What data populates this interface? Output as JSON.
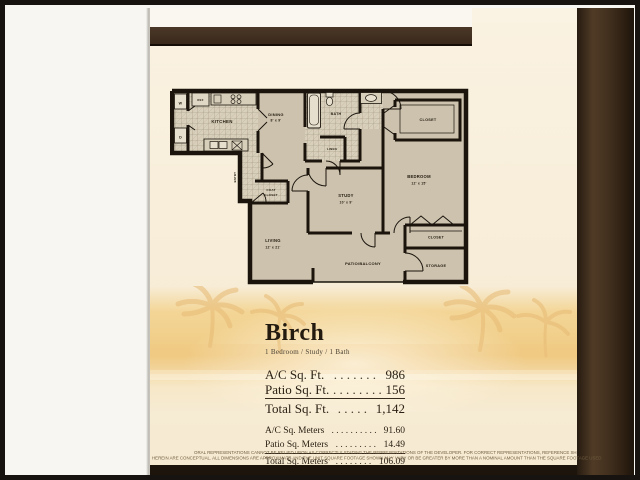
{
  "page": {
    "title": "Birch",
    "subtitle": "1 Bedroom / Study / 1 Bath",
    "stats_ft": [
      {
        "label": "A/C Sq. Ft.",
        "dots": ". . . . . . .",
        "value": "986"
      },
      {
        "label": "Patio Sq. Ft.",
        "dots": ". . . . . . . .",
        "value": "156"
      },
      {
        "label": "Total Sq. Ft.",
        "dots": ". . . . .",
        "value": "1,142"
      }
    ],
    "stats_meters": [
      {
        "label": "A/C Sq. Meters",
        "dots": ". . . . . . . . . .",
        "value": "91.60"
      },
      {
        "label": "Patio Sq. Meters",
        "dots": ". . . . . . . . .",
        "value": "14.49"
      },
      {
        "label": "Total Sq. Meters",
        "dots": ". . . . . . . .",
        "value": "106.09"
      }
    ],
    "disclaimer_line1": "ORAL REPRESENTATIONS CANNOT BE RELIED UPON AS CORRECTLY STATING THE REPRESENTATIONS OF THE DEVELOPER. FOR CORRECT REPRESENTATIONS, REFERENCE SH",
    "disclaimer_line2": "HEREIN ARE CONCEPTUAL. ALL DIMENSIONS ARE APPROXIMATE AND THE UNIT SQUARE FOOTAGE SHOWN MAY VARY OR BE GREATER BY MORE THAN A NOMINAL AMOUNT THAN THE SQUARE FOOTAGE USED"
  },
  "floorplan": {
    "labels": {
      "washer": "W",
      "dryer": "D",
      "ref": "REF",
      "kitchen": "KITCHEN",
      "dining": "DINING",
      "dining_dims": "8' x 9'",
      "bath": "BATH",
      "linen": "LINEN",
      "closet_top": "CLOSET",
      "bedroom": "BEDROOM",
      "bedroom_dims": "12' x 15'",
      "entry": "ENTRY",
      "coat": "COAT",
      "coat_closet": "CLOSET",
      "study": "STUDY",
      "study_dims": "10' x 9'",
      "living": "LIVING",
      "living_dims": "12' x 21'",
      "patio": "PATIO/BALCONY",
      "closet_bottom": "CLOSET",
      "storage": "STORAGE"
    }
  },
  "colors": {
    "page_cream": "#f8eeda",
    "plan_fill": "#cdc2ae",
    "wall": "#1a140c",
    "bar_brown": "#3f2e1f",
    "strip_brown": "#42301f",
    "photo_orange": "#eec589"
  }
}
